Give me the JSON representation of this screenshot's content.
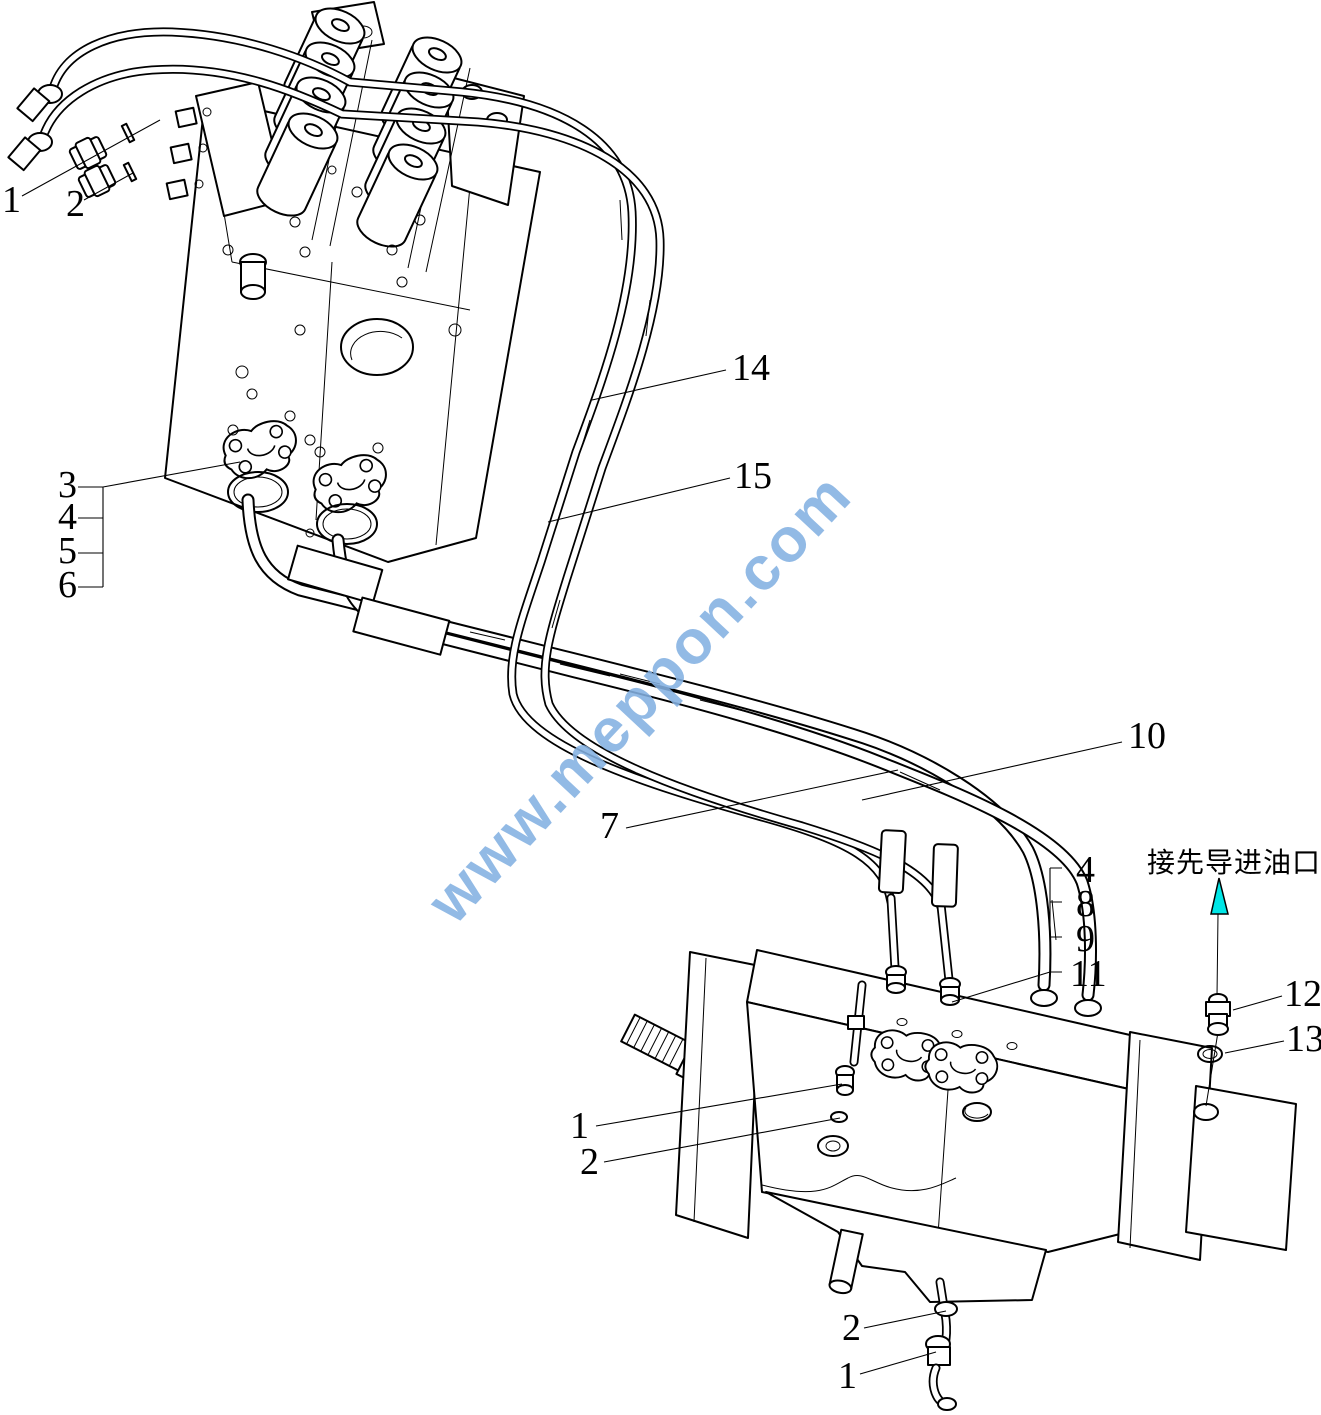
{
  "colors": {
    "line": "#000000",
    "watermark": "#84b1e2",
    "arrow": "#00e6e6",
    "background": "#ffffff"
  },
  "watermark": {
    "text": "www.meppon.com"
  },
  "annotation": {
    "pilot_port_note": "接先导进油口"
  },
  "callouts": {
    "top_1": "1",
    "top_2": "2",
    "left_3": "3",
    "left_4": "4",
    "left_5": "5",
    "left_6": "6",
    "hose_14": "14",
    "hose_15": "15",
    "hose_7": "7",
    "hose_10": "10",
    "right_4": "4",
    "right_8": "8",
    "right_9": "9",
    "right_11": "11",
    "fitting_12": "12",
    "oring_13": "13",
    "pump_1": "1",
    "pump_2": "2",
    "drain_2": "2",
    "drain_1": "1"
  }
}
